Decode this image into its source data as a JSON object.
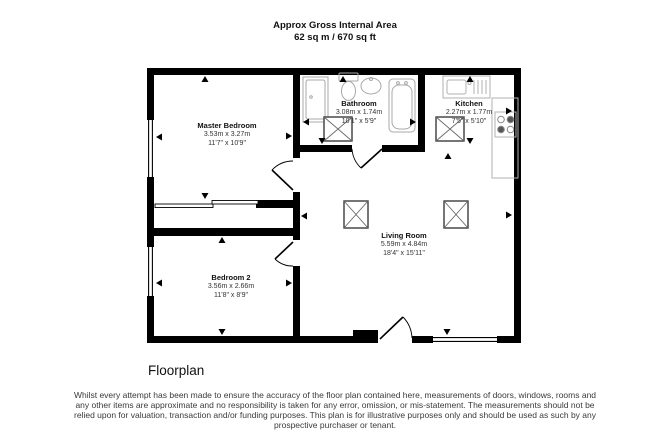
{
  "header": {
    "line1": "Approx Gross Internal Area",
    "line2": "62 sq m / 670 sq ft"
  },
  "rooms": {
    "master_bedroom": {
      "name": "Master Bedroom",
      "metric": "3.53m x 3.27m",
      "imperial": "11'7\" x 10'9\""
    },
    "bathroom": {
      "name": "Bathroom",
      "metric": "3.08m x 1.74m",
      "imperial": "10'1\" x 5'9\""
    },
    "kitchen": {
      "name": "Kitchen",
      "metric": "2.27m x 1.77m",
      "imperial": "7'5\" x 5'10\""
    },
    "bedroom_2": {
      "name": "Bedroom 2",
      "metric": "3.56m x 2.66m",
      "imperial": "11'8\" x 8'9\""
    },
    "living_room": {
      "name": "Living Room",
      "metric": "5.59m x 4.84m",
      "imperial": "18'4\" x 15'11\""
    }
  },
  "caption": "Floorplan",
  "disclaimer": {
    "line1": "Whilst every attempt has been made to ensure the accuracy of the floor plan contained here, measurements of doors, windows, rooms and",
    "line2": "any other items are approximate and no responsibility is taken for any error, omission, or mis-statement. The measurements should not be",
    "line3": "relied upon for valuation, transaction and/or funding purposes. This plan is for illustrative purposes only and should be used as such by any",
    "line4": "prospective purchaser or tenant."
  },
  "colors": {
    "wall": "#000000",
    "fixture_outline": "#a8a8a8",
    "skylight_outline": "#3c3c3c",
    "text": "#111111"
  }
}
